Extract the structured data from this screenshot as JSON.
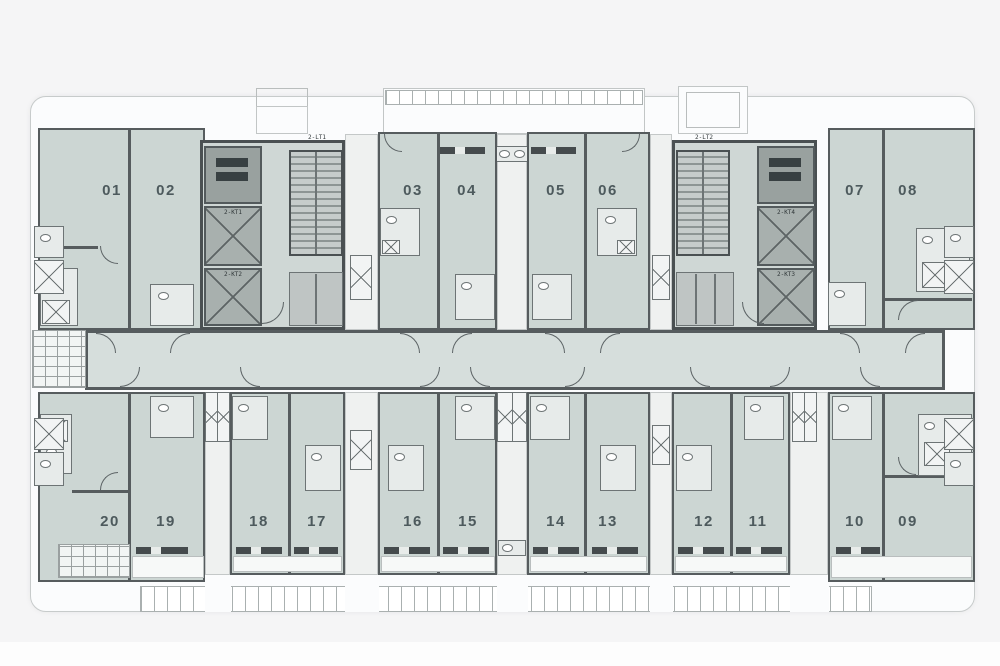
{
  "palette": {
    "background": "#f5f5f6",
    "plan_white": "#fbfcfd",
    "unit_fill": "#ccd6d3",
    "corridor_fill": "#d6dedc",
    "wall": "#565c5e",
    "core_fill": "#cfd7d5",
    "elevator_fill": "#a8b0ae",
    "label_color": "#4d5a5d"
  },
  "units": {
    "u01": {
      "label": "01"
    },
    "u02": {
      "label": "02"
    },
    "u03": {
      "label": "03"
    },
    "u04": {
      "label": "04"
    },
    "u05": {
      "label": "05"
    },
    "u06": {
      "label": "06"
    },
    "u07": {
      "label": "07"
    },
    "u08": {
      "label": "08"
    },
    "u09": {
      "label": "09"
    },
    "u10": {
      "label": "10"
    },
    "u11": {
      "label": "11"
    },
    "u12": {
      "label": "12"
    },
    "u13": {
      "label": "13"
    },
    "u14": {
      "label": "14"
    },
    "u15": {
      "label": "15"
    },
    "u16": {
      "label": "16"
    },
    "u17": {
      "label": "17"
    },
    "u18": {
      "label": "18"
    },
    "u19": {
      "label": "19"
    },
    "u20": {
      "label": "20"
    }
  },
  "cores": {
    "left": {
      "stair_label": "2-LT1",
      "elevator_labels": [
        "2-KT1",
        "2-KT2"
      ]
    },
    "right": {
      "stair_label": "2-LT2",
      "elevator_labels": [
        "2-KT4",
        "2-KT3"
      ]
    }
  }
}
